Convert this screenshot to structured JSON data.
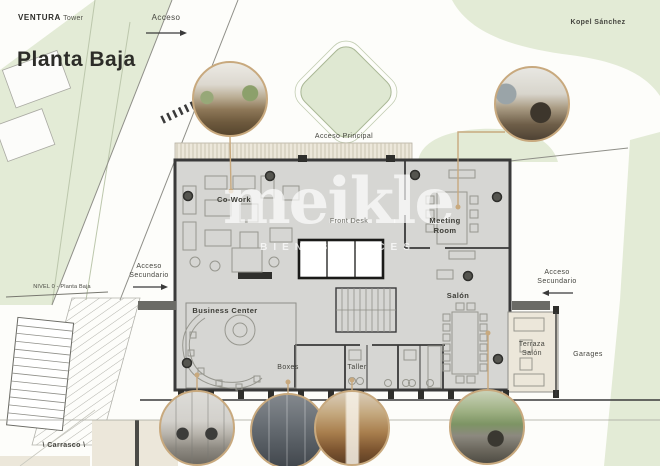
{
  "header": {
    "brand_bold": "VENTURA",
    "brand_light": "Tower",
    "architect": "Kopel Sánchez",
    "title": "Planta Baja"
  },
  "watermark": {
    "brand": "meikle",
    "tagline": "BIENES RAICES"
  },
  "site": {
    "acceso": "Acceso",
    "acceso_principal": "Acceso Principal",
    "acceso_sec_line1": "Acceso",
    "acceso_sec_line2": "Secundario",
    "nivel": "NIVEL 0 - Planta Baja",
    "carrasco": "\\ Carrasco \\",
    "garages": "Garages"
  },
  "rooms": {
    "cowork": {
      "label": "Co-Work"
    },
    "front_desk": {
      "label": "Front Desk"
    },
    "meeting": {
      "line1": "Meeting",
      "line2": "Room"
    },
    "salon": {
      "label": "Salón"
    },
    "business": {
      "label": "Business Center"
    },
    "boxes": {
      "label": "Boxes"
    },
    "taller": {
      "label": "Taller"
    },
    "terraza": {
      "line1": "Terraza",
      "line2": "Salón"
    }
  },
  "insets": {
    "cowork": "co-work-interior-photo",
    "meeting": "meeting-room-interior-photo",
    "business": "business-center-interior-photo",
    "boxes": "boxes-interior-photo",
    "taller": "taller-interior-photo",
    "salon": "salon-terrace-interior-photo"
  },
  "colors": {
    "green_area": "#e3ebd6",
    "building_fill": "#d6d6d3",
    "wall": "#3a3a3a",
    "accent_tan": "#c8a97e",
    "deck_beige": "#ece7da"
  }
}
